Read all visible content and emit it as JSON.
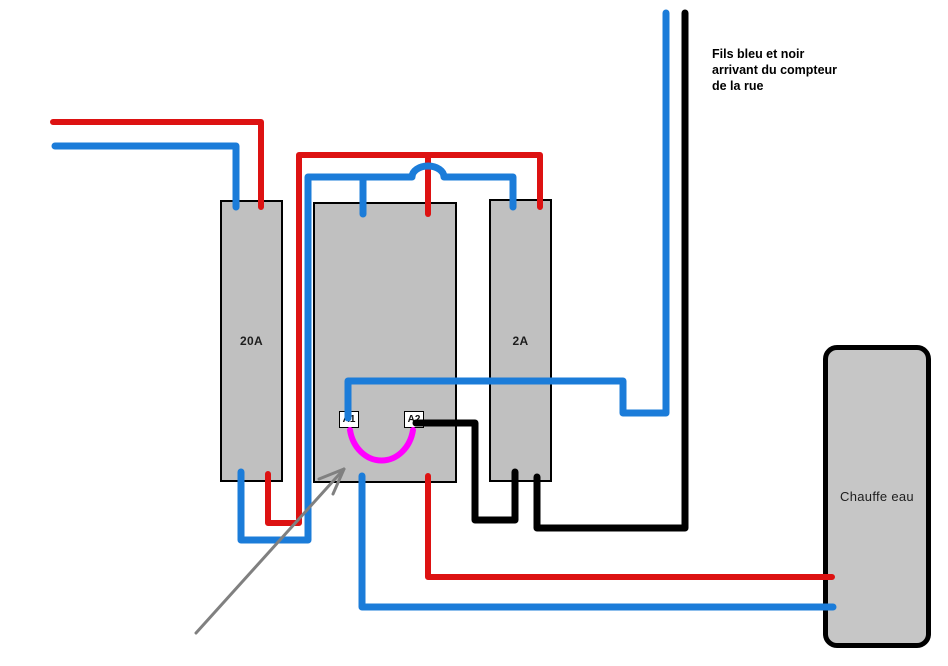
{
  "note": {
    "lines": [
      "Fils bleu et noir",
      "arrivant du compteur",
      "de la rue"
    ]
  },
  "components": {
    "breaker_20a": {
      "label": "20A"
    },
    "contactor": {
      "a1": "A1",
      "a2": "A2"
    },
    "breaker_2a": {
      "label": "2A"
    },
    "water_heater": {
      "label": "Chauffe eau"
    }
  },
  "colors": {
    "wire-red": "#dd1212",
    "wire-blue": "#1b7cd9",
    "wire-black": "#000000",
    "wire-magenta": "#ff00ff",
    "arrow-gray": "#808080",
    "box-fill": "#c0c0c0",
    "box-border": "#000000"
  }
}
